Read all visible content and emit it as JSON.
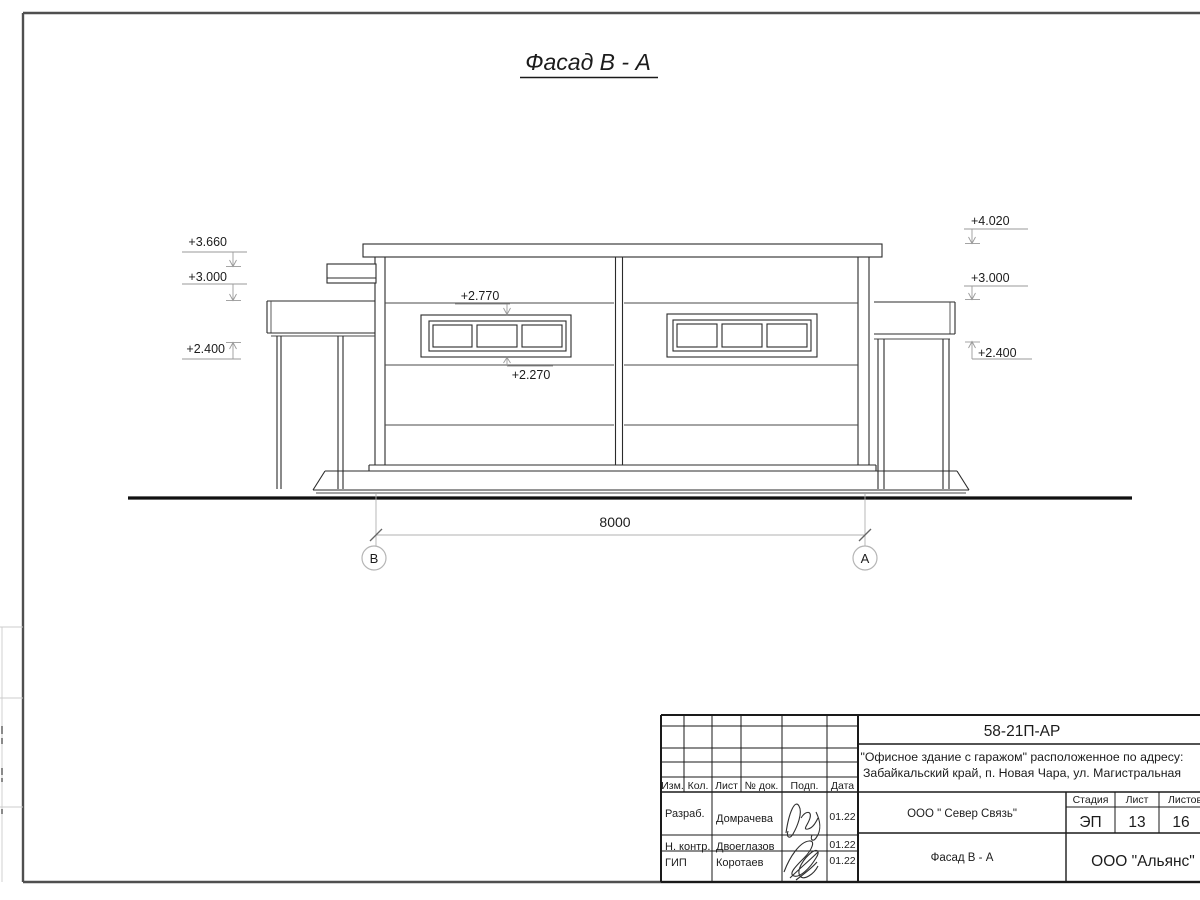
{
  "sheet": {
    "title": "Фасад В - А"
  },
  "elevation": {
    "marks_left": [
      {
        "value": "+3.660"
      },
      {
        "value": "+3.000"
      },
      {
        "value": "+2.400"
      }
    ],
    "marks_right": [
      {
        "value": "+4.020"
      },
      {
        "value": "+3.000"
      },
      {
        "value": "+2.400"
      }
    ],
    "window_top_mark": "+2.770",
    "window_bottom_mark": "+2.270",
    "dimension_width": "8000",
    "axis_left": "В",
    "axis_right": "А"
  },
  "title_block": {
    "doc_number": "58-21П-АР",
    "project_address_line1": "\"Офисное здание с гаражом\" расположенное по адресу:",
    "project_address_line2": "Забайкальский край, п. Новая Чара, ул. Магистральная",
    "columns": {
      "izm": "Изм.",
      "kol": "Кол.",
      "list": "Лист",
      "doc": "№ док.",
      "podp": "Подп.",
      "data": "Дата"
    },
    "rows": [
      {
        "role": "Разраб.",
        "name": "Домрачева",
        "date": "01.22"
      },
      {
        "role": "Н. контр.",
        "name": "Двоеглазов",
        "date": "01.22"
      },
      {
        "role": "ГИП",
        "name": "Коротаев",
        "date": "01.22"
      }
    ],
    "contractor": "ООО \" Север Связь\"",
    "stage_label": "Стадия",
    "sheet_label": "Лист",
    "sheets_label": "Листов",
    "stage": "ЭП",
    "sheet_number": "13",
    "sheets_total": "16",
    "drawing_name": "Фасад В - А",
    "organization": "ООО \"Альянс\""
  }
}
